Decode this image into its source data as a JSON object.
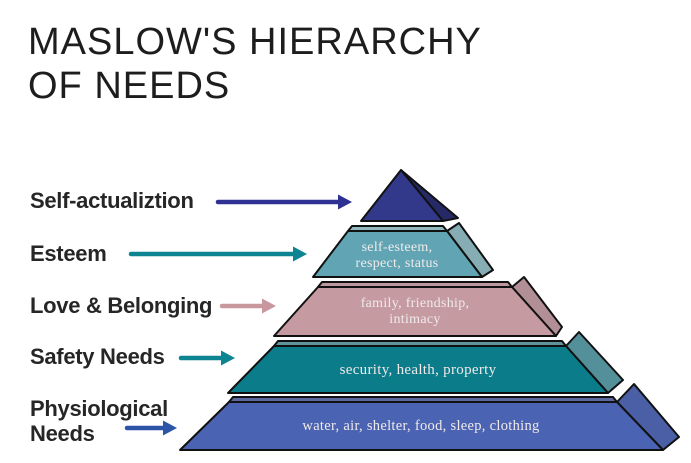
{
  "title": {
    "line1": "MASLOW'S HIERARCHY",
    "line2": "OF NEEDS"
  },
  "labels": [
    {
      "text": "Self-actualiztion",
      "arrow_color": "#2e3191"
    },
    {
      "text": "Esteem",
      "arrow_color": "#0d8491"
    },
    {
      "text": "Love & Belonging",
      "arrow_color": "#c9979e"
    },
    {
      "text": "Safety Needs",
      "arrow_color": "#0d8491"
    },
    {
      "lines": [
        "Physiological",
        "Needs"
      ],
      "arrow_color": "#2d55a7"
    }
  ],
  "pyramid": {
    "text_color": "#f0eaea",
    "levels": [
      {
        "name": "self-actualization",
        "front_color": "#32388a",
        "side_color": "#252a66",
        "lines": []
      },
      {
        "name": "esteem",
        "front_color": "#61a5b5",
        "side_color": "#85adb3",
        "top_color": "#92b9bf",
        "lines": [
          "self-esteem,",
          "respect, status"
        ]
      },
      {
        "name": "love-belonging",
        "front_color": "#c59ba1",
        "side_color": "#b28f97",
        "top_color": "#bd989f",
        "lines": [
          "family, friendship,",
          "intimacy"
        ]
      },
      {
        "name": "safety",
        "front_color": "#0b7c89",
        "side_color": "#54909a",
        "top_color": "#60949c",
        "lines": [
          "security, health, property"
        ]
      },
      {
        "name": "physiological",
        "front_color": "#4a63b2",
        "side_color": "#4a5fa5",
        "top_color": "#5b699e",
        "lines": [
          "water, air, shelter, food, sleep, clothing"
        ]
      }
    ]
  }
}
